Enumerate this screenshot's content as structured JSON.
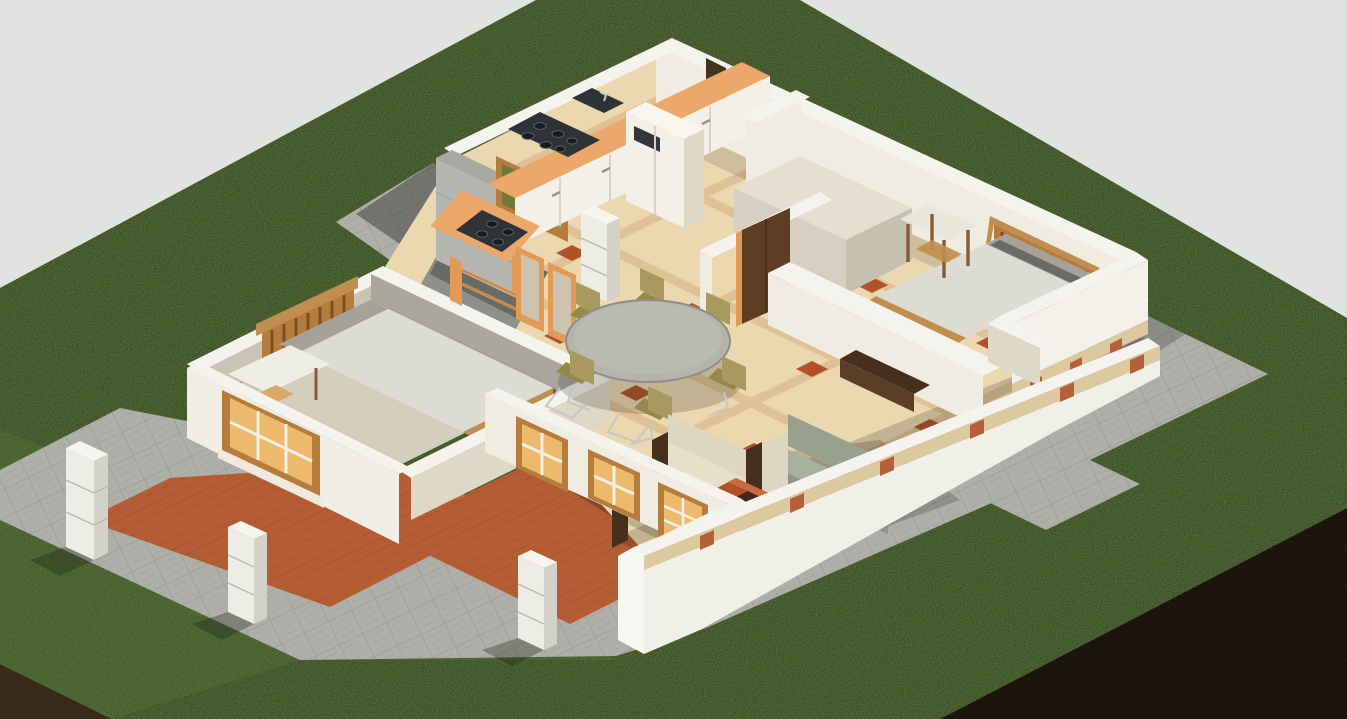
{
  "meta": {
    "title": "Isometric 3D cutaway rendering of a single-storey house floor plan",
    "view": "axonometric birds-eye, walls cut at sill height",
    "canvas": {
      "width": 1347,
      "height": 719
    }
  },
  "colors": {
    "bg": "#e0e3e0",
    "grass": "#81a854",
    "grassShade": "#6f9747",
    "soil": "#382a1a",
    "soilLight": "#453521",
    "paver": "#aeafa8",
    "paverShadow": "#5f625d",
    "paverJoint": "#90918a",
    "deck": "#b45c33",
    "deckLine": "#8a421f",
    "wallTop": "#f5f3ed",
    "wallLight": "#efece2",
    "wallMedium": "#ded8c7",
    "wallShadow": "#b3ada0",
    "wallBlock": "#b5b6af",
    "plinth": "#dcc9a0",
    "brickAccent": "#b4603a",
    "floorTile": "#ebd8b0",
    "tileBand": "#dcbe90",
    "tileAccent": "#b2502c",
    "bedroomFloor": "#d4cebd",
    "counter": "#eca76a",
    "counterSide": "#d38d4d",
    "cooktop": "#2f3338",
    "burner": "#171a1e",
    "cabinet": "#f3f0e7",
    "fridgePanel": "#33373c",
    "woodDark": "#46301d",
    "woodMid": "#7c5026",
    "woodTan": "#c08f4f",
    "headboard": "#b67c3c",
    "doorBrown": "#5d3d24",
    "orangeTrim": "#e29a57",
    "mattress": "#dddcd4",
    "mattressShade": "#a5a299",
    "sofaCream": "#ddd6c0",
    "sofaSage": "#99a08e",
    "sofaSageLight": "#aab09e",
    "tableGray": "#b5b4ac",
    "tableRim": "#8f8e86",
    "chairOlive": "#a89a5e",
    "windowAmber": "#ecb96d",
    "windowFrame": "#b67c3c",
    "plantGreen": "#6c7a3a",
    "plantGreenLight": "#8b9a4d",
    "pillar": "#edece5",
    "pillarShade": "#d3d2c9"
  },
  "scene": {
    "ground": [
      "grass-lawn",
      "soil-cut-left",
      "soil-cut-right"
    ],
    "hardscape": [
      "north-paver-terrace",
      "east-paver-patio",
      "south-paver-path",
      "southwest-paver-apron",
      "wood-deck-left",
      "wood-deck-center",
      "white-block-pillars"
    ],
    "rooms": [
      "kitchen",
      "dining-area",
      "living-area",
      "bedroom-right",
      "bedroom-left",
      "entry-hall"
    ],
    "kitchen_items": [
      "l-shaped-counter",
      "sink",
      "cooktop-4-burner",
      "cooktop-lower",
      "garden-window-plants",
      "tall-fridge-cabinet",
      "base-cabinets"
    ],
    "dining_items": [
      "round-dining-table",
      "dining-chairs-x6",
      "chrome-chair-frames"
    ],
    "living_items": [
      "armchair-a",
      "armchair-b",
      "sofa-sage",
      "coffee-table-terracotta",
      "wood-console"
    ],
    "bedroom_right_items": [
      "bed-gray-mattress",
      "slatted-headboard",
      "wardrobe-box",
      "wood-side-stool",
      "wood-bench",
      "brown-door"
    ],
    "bedroom_left_items": [
      "bed-gray-mattress",
      "slatted-headboard",
      "white-side-table",
      "amber-window"
    ],
    "entry_items": [
      "orange-french-door",
      "orange-gate-rail",
      "white-entry-pillar"
    ]
  }
}
